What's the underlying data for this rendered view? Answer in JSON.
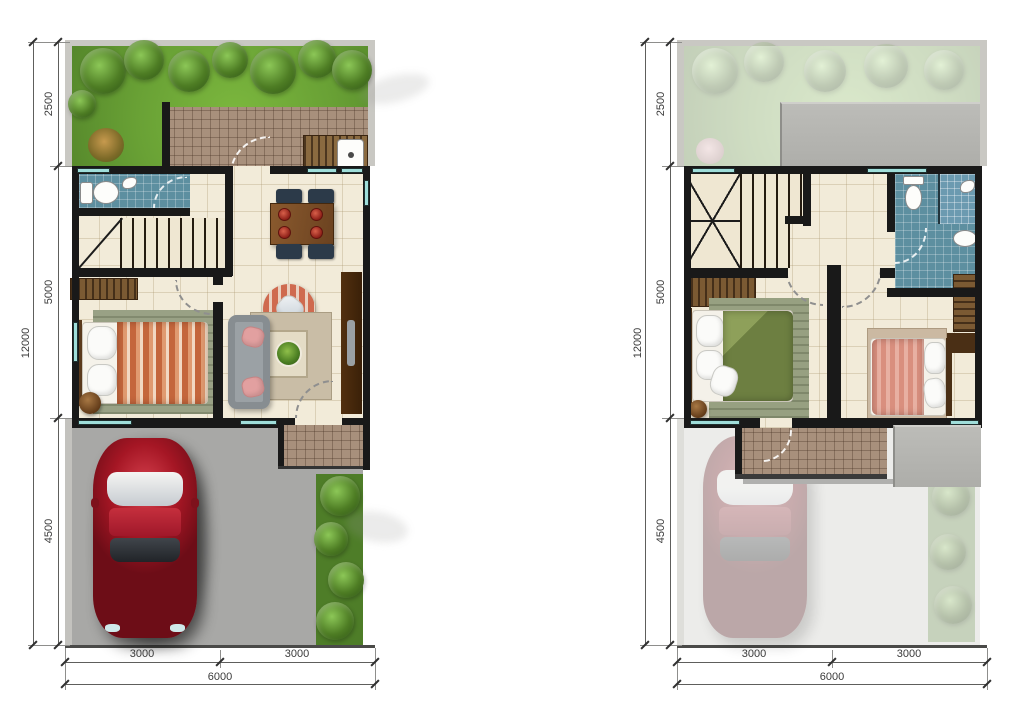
{
  "figure": {
    "type": "floor-plan-pair",
    "units": "mm"
  },
  "plans": [
    {
      "title": "ground-floor-plan",
      "dims_vertical": {
        "segments": [
          "2500",
          "5000",
          "4500"
        ],
        "total": "12000"
      },
      "dims_horizontal": {
        "segments": [
          "3000",
          "3000"
        ],
        "total": "6000"
      }
    },
    {
      "title": "upper-floor-plan",
      "dims_vertical": {
        "segments": [
          "2500",
          "5000",
          "4500"
        ],
        "total": "12000"
      },
      "dims_horizontal": {
        "segments": [
          "3000",
          "3000"
        ],
        "total": "6000"
      }
    }
  ],
  "colors": {
    "wall": "#191919",
    "window": "#9fdeda",
    "grass": "#69a135",
    "floor_tile": "#f2ebd9",
    "terrace_tile": "#a8907c",
    "bathroom_tile": "#5d8fa0",
    "driveway": "#a8a8a6",
    "roof": "#b5b5b1",
    "car": "#a51624",
    "dimension_text": "#3b3b3b"
  }
}
